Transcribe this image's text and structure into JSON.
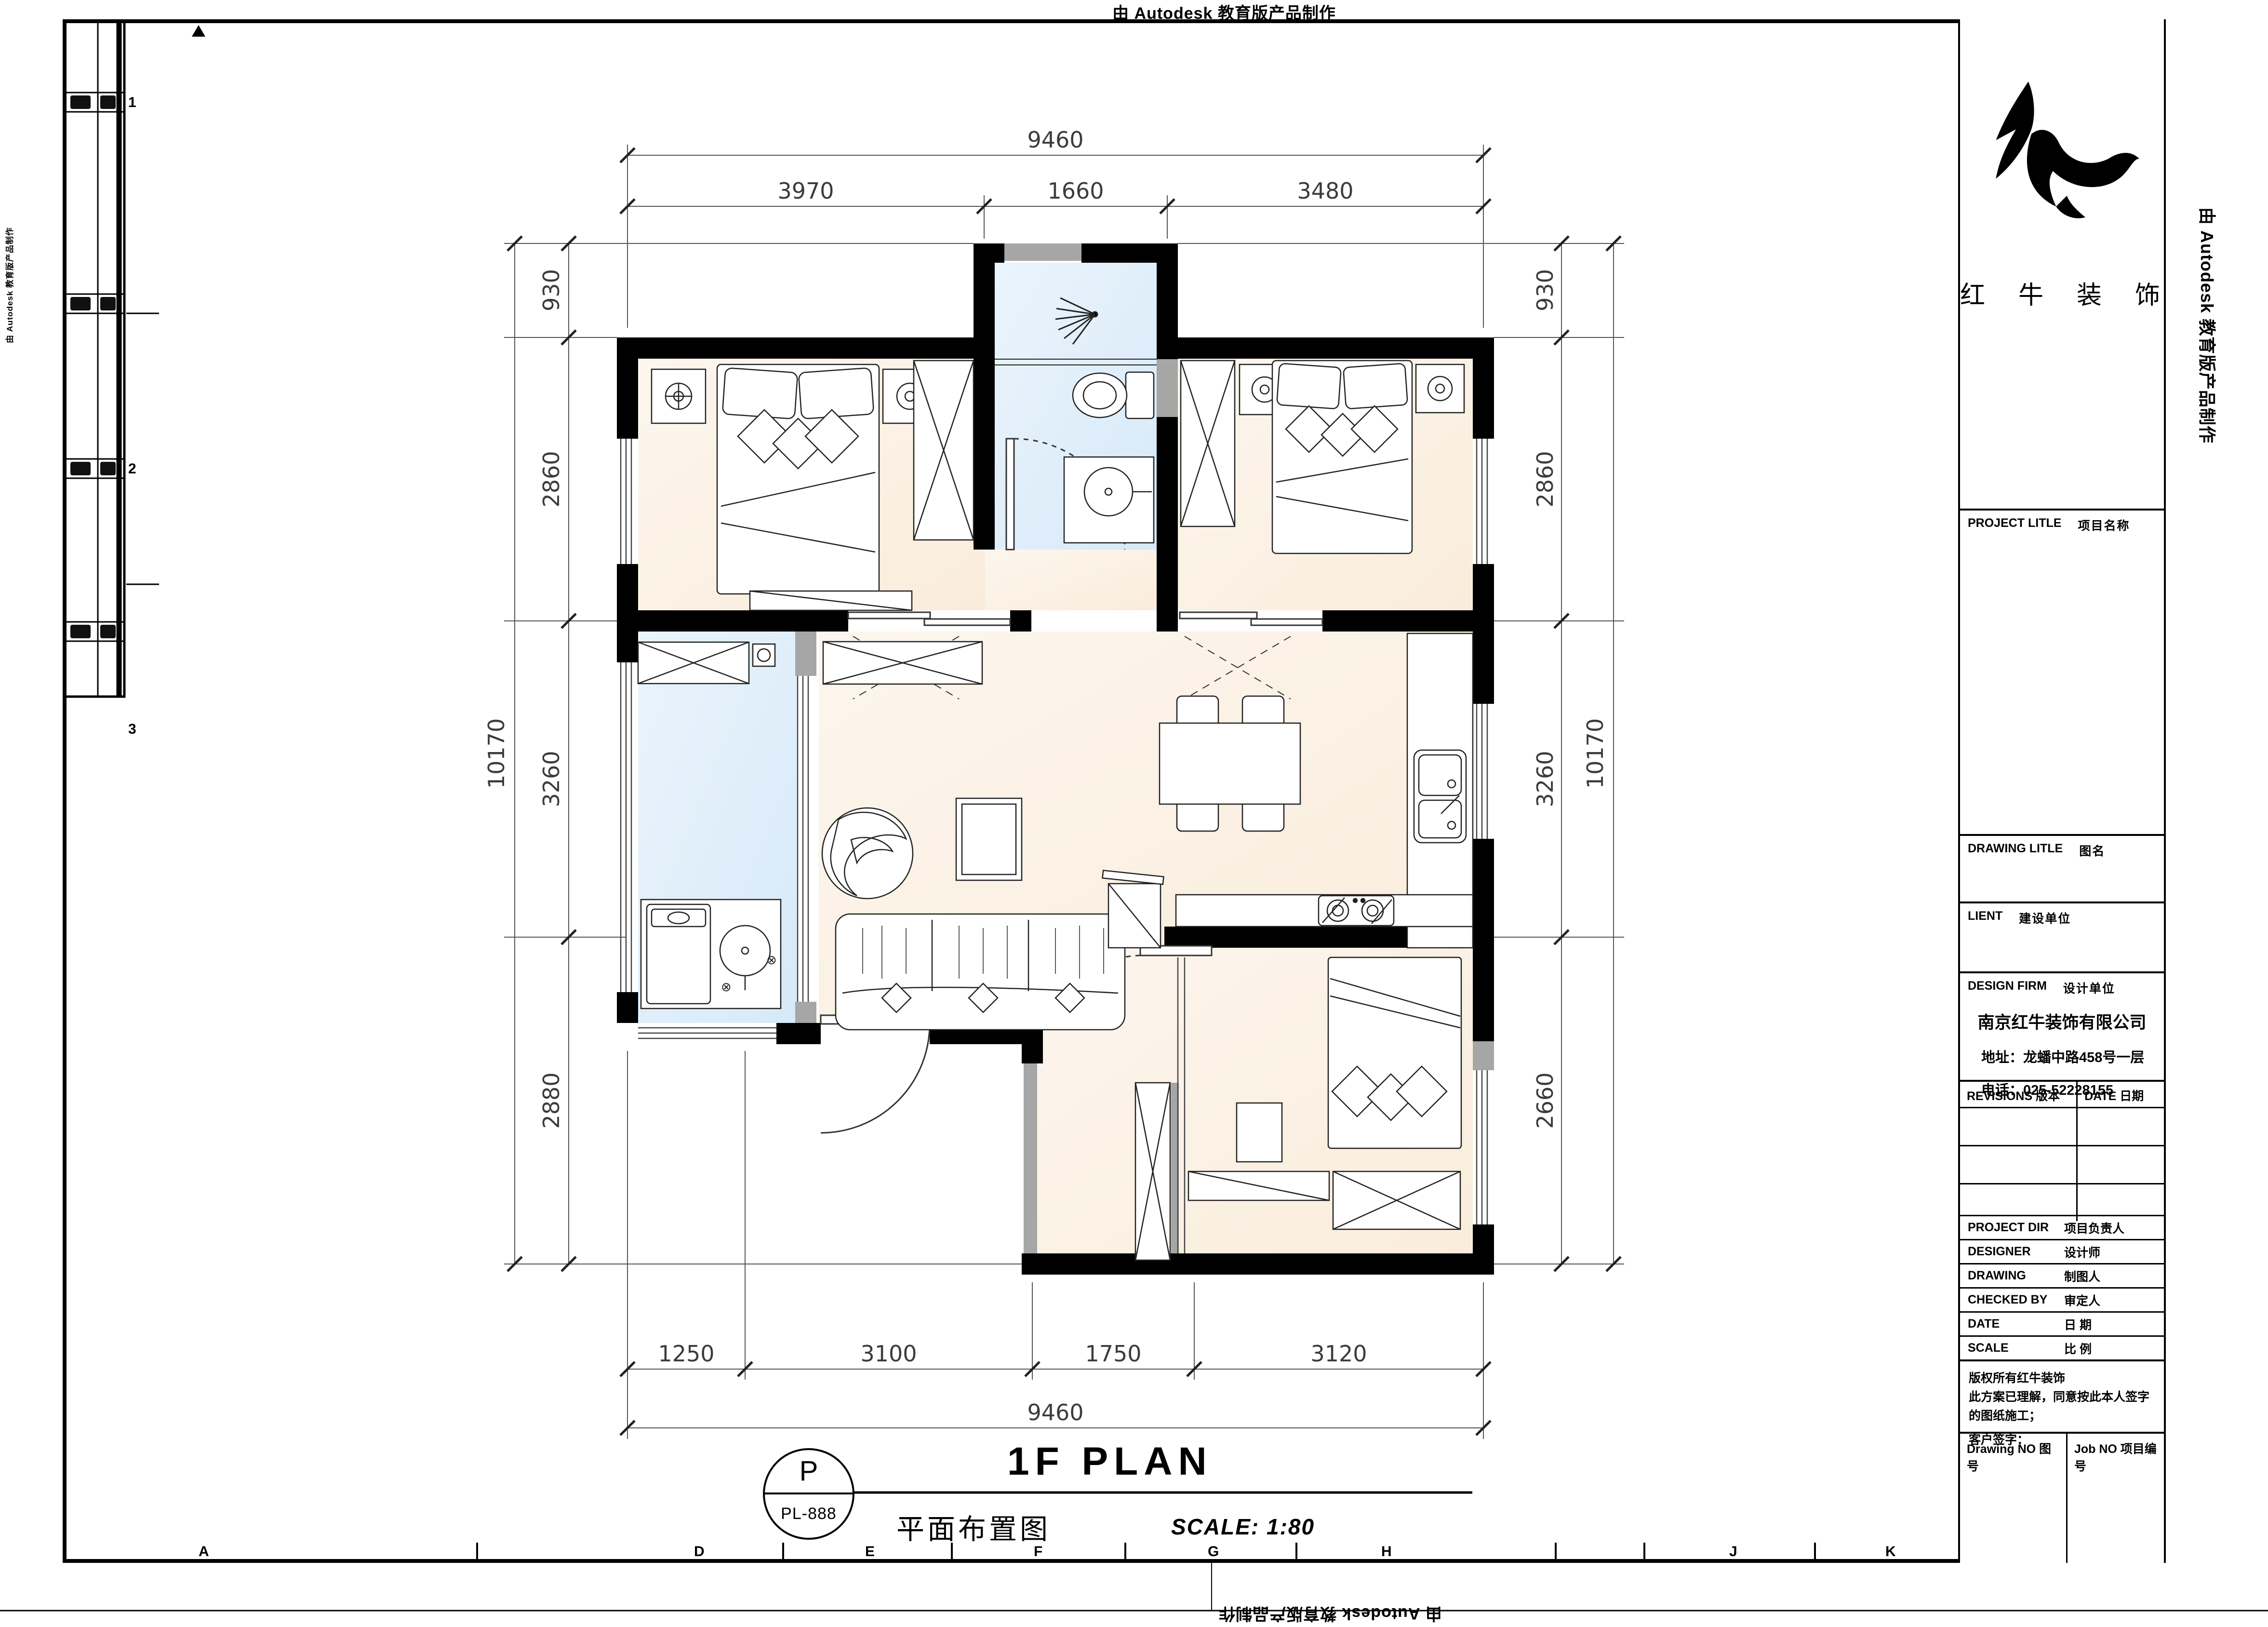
{
  "autodesk_banner": "由 Autodesk 教育版产品制作",
  "title_block": {
    "logo_text": "红 牛 装 饰",
    "project_row": {
      "label": "PROJECT LITLE",
      "label_cn": "项目名称"
    },
    "drawing_row": {
      "label": "DRAWING LITLE",
      "label_cn": "图名"
    },
    "client_row": {
      "label": "LIENT",
      "label_cn": "建设单位"
    },
    "designfirm_row": {
      "label": "DESIGN FIRM",
      "label_cn": "设计单位"
    },
    "firm": {
      "name": "南京红牛装饰有限公司",
      "address": "地址：龙蟠中路458号一层",
      "phone": "电话：025-52228155"
    },
    "revisions_label": "REVISIONS 版本",
    "date_label": "DATE 日期",
    "staff_rows": [
      {
        "label": "PROJECT DIR",
        "label_cn": "项目负责人"
      },
      {
        "label": "DESIGNER",
        "label_cn": "设计师"
      },
      {
        "label": "DRAWING",
        "label_cn": "制图人"
      },
      {
        "label": "CHECKED BY",
        "label_cn": "审定人"
      },
      {
        "label": "DATE",
        "label_cn": "日  期"
      },
      {
        "label": "SCALE",
        "label_cn": "比  例"
      }
    ],
    "notes": [
      "版权所有红牛装饰",
      "此方案已理解，同意按此本人签字的图纸施工；",
      "客户签字："
    ],
    "drawing_no_label": "Drawing NO  图号",
    "job_no_label": "Job NO  项目编号"
  },
  "title_bar": {
    "bubble_top": "P",
    "bubble_bottom": "PL-888",
    "title": "1F PLAN",
    "subtitle": "平面布置图",
    "scale": "SCALE: 1:80"
  },
  "dimensions": {
    "top": {
      "total": "9460",
      "segments": [
        "3970",
        "1660",
        "3480"
      ]
    },
    "bottom": {
      "total": "9460",
      "segments": [
        "1250",
        "3100",
        "1750",
        "3120"
      ]
    },
    "left": {
      "total": "10170",
      "segments": [
        "930",
        "2860",
        "3260",
        "2880"
      ]
    },
    "right": {
      "total": "10170",
      "segments": [
        "930",
        "2860",
        "3260",
        "2660"
      ]
    }
  },
  "grid_letters_bottom": [
    "A",
    "D",
    "E",
    "F",
    "G",
    "H",
    "J",
    "K"
  ],
  "grid_numbers_left": [
    "1",
    "2",
    "3"
  ]
}
